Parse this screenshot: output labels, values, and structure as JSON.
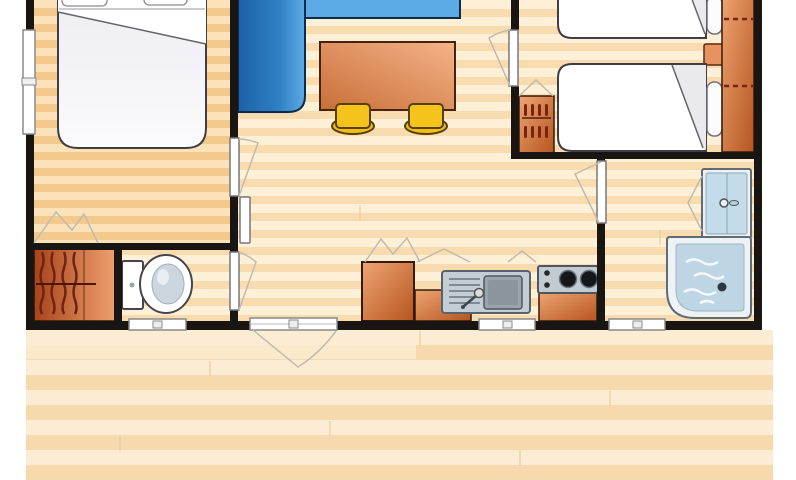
{
  "scene": {
    "type": "architectural-floor-plan",
    "subject": "mobile-home holiday cottage floor plan, top-down view, wood flooring, front deck terrace",
    "rooms": [
      {
        "id": "bedroom-double",
        "position": "top-left",
        "furniture": [
          "double-bed",
          "pillows",
          "side-window",
          "closet-with-hanging-clothes",
          "bifold-closet-doors"
        ]
      },
      {
        "id": "living-kitchen",
        "position": "center",
        "furniture": [
          "corner-sofa-blue",
          "dining-table",
          "stool",
          "stool",
          "fridge-cabinet",
          "sink-with-drainboard",
          "two-burner-hob",
          "kitchen-counters",
          "entrance-door-to-deck",
          "kitchen-window"
        ]
      },
      {
        "id": "bedroom-twin",
        "position": "top-right",
        "furniture": [
          "twin-bed",
          "twin-bed",
          "pillows",
          "nightstand",
          "wardrobe-with-hanging-rail",
          "shelf-cabinet"
        ]
      },
      {
        "id": "wc",
        "position": "bottom-left",
        "furniture": [
          "toilet",
          "small-window"
        ]
      },
      {
        "id": "shower-room",
        "position": "bottom-right",
        "furniture": [
          "washbasin-unit",
          "shower-tray",
          "small-window"
        ]
      },
      {
        "id": "deck-terrace",
        "position": "bottom",
        "furniture": []
      }
    ],
    "doors": [
      "double-bedroom-door",
      "wc-door",
      "twin-bedroom-door",
      "shower-room-door",
      "entrance-door"
    ]
  },
  "colors": {
    "wall": "#181512",
    "floor-a": "#fdf0d6",
    "floor-b": "#f8dcb0",
    "floor-bed-a": "#fbe2b8",
    "floor-bed-b": "#f4c98e",
    "deck-a": "#fcecd4",
    "deck-b": "#f7d9ae",
    "sofa-dark": "#1d61a6",
    "sofa-mid": "#2f7ec4",
    "sofa-light": "#5cabe6",
    "orange-d": "#b5551f",
    "orange-l": "#efa573",
    "table-d": "#c96f38",
    "table-l": "#f4b489",
    "closet-d": "#a7431b",
    "closet-l": "#ee9f6e",
    "stool": "#f6c31d",
    "steel": "#c4cdd4",
    "steel-d": "#99a4ab",
    "fix-blue": "#c4dbe9",
    "shower-blue": "#bed6e4",
    "swing": "#c2bbac",
    "outline": "#3e3e44",
    "fixture-white": "#ffffff"
  }
}
